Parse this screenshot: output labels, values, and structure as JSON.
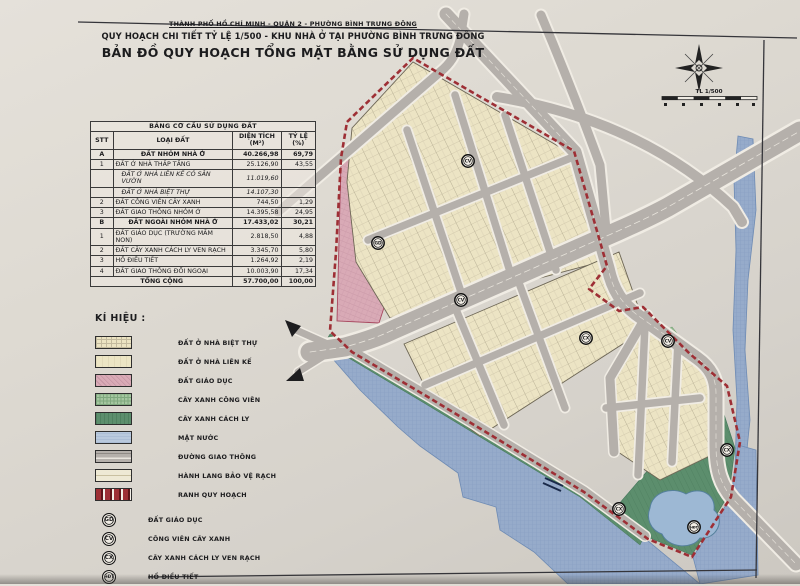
{
  "header": {
    "line1": "THÀNH PHỐ HỒ CHÍ MINH - QUẬN 2 - PHƯỜNG BÌNH TRƯNG ĐÔNG",
    "line2": "QUY HOẠCH CHI TIẾT TỶ LỆ 1/500 - KHU NHÀ Ở TẠI PHƯỜNG BÌNH TRƯNG ĐÔNG",
    "line3": "BẢN ĐỒ QUY HOẠCH TỔNG MẶT BẰNG SỬ DỤNG ĐẤT"
  },
  "land_use_table": {
    "title": "BẢNG CƠ CẤU SỬ DỤNG ĐẤT",
    "columns": [
      {
        "label": "STT",
        "sub": ""
      },
      {
        "label": "LOẠI ĐẤT",
        "sub": ""
      },
      {
        "label": "DIỆN TÍCH",
        "sub": "(M²)"
      },
      {
        "label": "TỶ LỆ",
        "sub": "(%)"
      }
    ],
    "rows": [
      {
        "stt": "A",
        "loai": "ĐẤT NHÓM NHÀ Ở",
        "dien_tich": "40.266,98",
        "ty_le": "69,79",
        "style": "section"
      },
      {
        "stt": "1",
        "loai": "ĐẤT Ở NHÀ THẤP TẦNG",
        "dien_tich": "25.126,90",
        "ty_le": "43,55",
        "style": "normal"
      },
      {
        "stt": "",
        "loai": "ĐẤT Ở NHÀ LIÊN KẾ CÓ SÂN VƯỜN",
        "dien_tich": "11.019,60",
        "ty_le": "",
        "style": "italic"
      },
      {
        "stt": "",
        "loai": "ĐẤT Ở NHÀ BIỆT THỰ",
        "dien_tich": "14.107,30",
        "ty_le": "",
        "style": "italic"
      },
      {
        "stt": "2",
        "loai": "ĐẤT CÔNG VIÊN CÂY XANH",
        "dien_tich": "744,50",
        "ty_le": "1,29",
        "style": "normal"
      },
      {
        "stt": "3",
        "loai": "ĐẤT GIAO THÔNG NHÓM Ở",
        "dien_tich": "14.395,58",
        "ty_le": "24,95",
        "style": "normal"
      },
      {
        "stt": "B",
        "loai": "ĐẤT NGOÀI NHÓM NHÀ Ở",
        "dien_tich": "17.433,02",
        "ty_le": "30,21",
        "style": "section"
      },
      {
        "stt": "1",
        "loai": "ĐẤT GIÁO DỤC (TRƯỜNG MẦM NON)",
        "dien_tich": "2.818,50",
        "ty_le": "4,88",
        "style": "normal"
      },
      {
        "stt": "2",
        "loai": "ĐẤT CÂY XANH CÁCH LY VEN RẠCH",
        "dien_tich": "3.345,70",
        "ty_le": "5,80",
        "style": "normal"
      },
      {
        "stt": "3",
        "loai": "HỒ ĐIỀU TIẾT",
        "dien_tich": "1.264,92",
        "ty_le": "2,19",
        "style": "normal"
      },
      {
        "stt": "4",
        "loai": "ĐẤT GIAO THÔNG ĐỐI NGOẠI",
        "dien_tich": "10.003,90",
        "ty_le": "17,34",
        "style": "normal"
      }
    ],
    "total_row": {
      "label": "TỔNG CỘNG",
      "dien_tich": "57.700,00",
      "ty_le": "100,00"
    }
  },
  "legend": {
    "title": "KÍ HIỆU :",
    "swatches": [
      {
        "label": "ĐẤT Ở NHÀ BIỆT THỰ",
        "type": "villa"
      },
      {
        "label": "ĐẤT Ở NHÀ LIÊN KẾ",
        "type": "rowhouse"
      },
      {
        "label": "ĐẤT GIÁO DỤC",
        "type": "education"
      },
      {
        "label": "CÂY XANH CÔNG VIÊN",
        "type": "park"
      },
      {
        "label": "CÂY XANH CÁCH LY",
        "type": "buffer"
      },
      {
        "label": "MẶT NƯỚC",
        "type": "water"
      },
      {
        "label": "ĐƯỜNG GIAO THÔNG",
        "type": "road"
      },
      {
        "label": "HÀNH LANG BẢO VỆ RẠCH",
        "type": "corridor"
      },
      {
        "label": "RANH QUY HOẠCH",
        "type": "boundary"
      }
    ],
    "symbols": [
      {
        "code": "GD",
        "label": "ĐẤT GIÁO DỤC"
      },
      {
        "code": "CV",
        "label": "CÔNG VIÊN CÂY XANH"
      },
      {
        "code": "CX",
        "label": "CÂY XANH CÁCH LY VEN RẠCH"
      },
      {
        "code": "HĐT",
        "label": "HỒ ĐIỀU TIẾT"
      }
    ]
  },
  "map": {
    "scale_label": "TL 1/500",
    "markers": [
      {
        "code": "GD",
        "x": 378,
        "y": 243
      },
      {
        "code": "CV",
        "x": 468,
        "y": 161
      },
      {
        "code": "CV",
        "x": 461,
        "y": 300
      },
      {
        "code": "CV",
        "x": 668,
        "y": 341
      },
      {
        "code": "CX",
        "x": 586,
        "y": 338
      },
      {
        "code": "CX",
        "x": 619,
        "y": 509
      },
      {
        "code": "CX",
        "x": 727,
        "y": 450
      },
      {
        "code": "HĐT",
        "x": 694,
        "y": 527
      }
    ],
    "colors": {
      "boundary_red": "#9e2f35",
      "water_blue": "#96abca",
      "residential_cream": "#ece4c4",
      "education_pink": "#d9aab6",
      "park_green_light": "#a5c6a0",
      "buffer_green_dark": "#5c8e6d",
      "road_gray": "#b5b0ab"
    }
  }
}
